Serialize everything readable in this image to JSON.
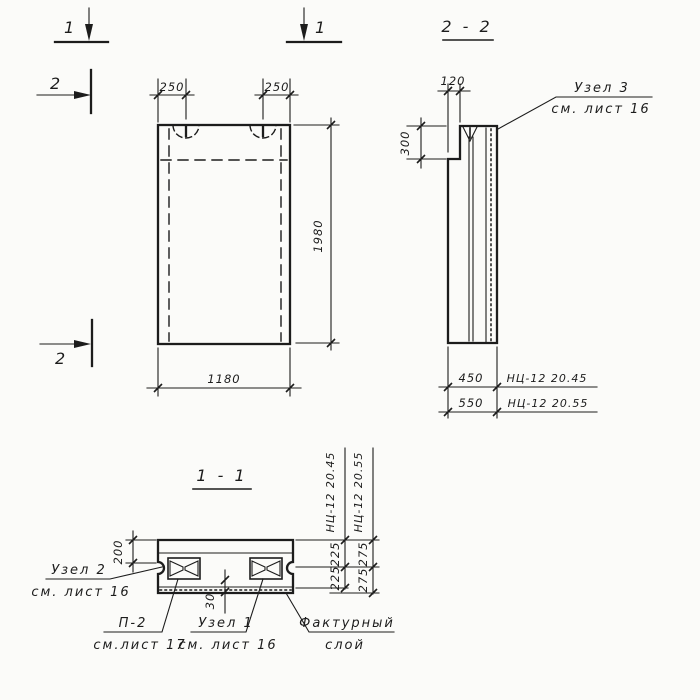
{
  "markers": {
    "sec1_left": "1",
    "sec1_right": "1",
    "sec2_top": "2",
    "sec2_bottom": "2"
  },
  "front_view": {
    "dim_anchor_left": "250",
    "dim_anchor_right": "250",
    "dim_height": "1980",
    "dim_width": "1180"
  },
  "section_2_2": {
    "title": "2 - 2",
    "dim_top": "120",
    "dim_step": "300",
    "node3": {
      "label": "Узел 3",
      "ref": "см. лист 16"
    },
    "thickness_rows": [
      {
        "dim": "450",
        "mark": "НЦ-12 20.45"
      },
      {
        "dim": "550",
        "mark": "НЦ-12 20.55"
      }
    ]
  },
  "section_1_1": {
    "title": "1 - 1",
    "dim_flange": "200",
    "dim_layer": "30",
    "col45": {
      "mark": "НЦ-12 20.45",
      "dim_top": "225",
      "dim_bottom": "225"
    },
    "col55": {
      "mark": "НЦ-12 20.55",
      "dim_top": "275",
      "dim_bottom": "275"
    },
    "node2": {
      "label": "Узел 2",
      "ref": "см. лист 16"
    },
    "p2": {
      "label": "П-2",
      "ref": "см.лист 17"
    },
    "node1": {
      "label": "Узел 1",
      "ref": "см. лист 16"
    },
    "facing": {
      "label": "Фактурный",
      "label2": "слой"
    }
  }
}
